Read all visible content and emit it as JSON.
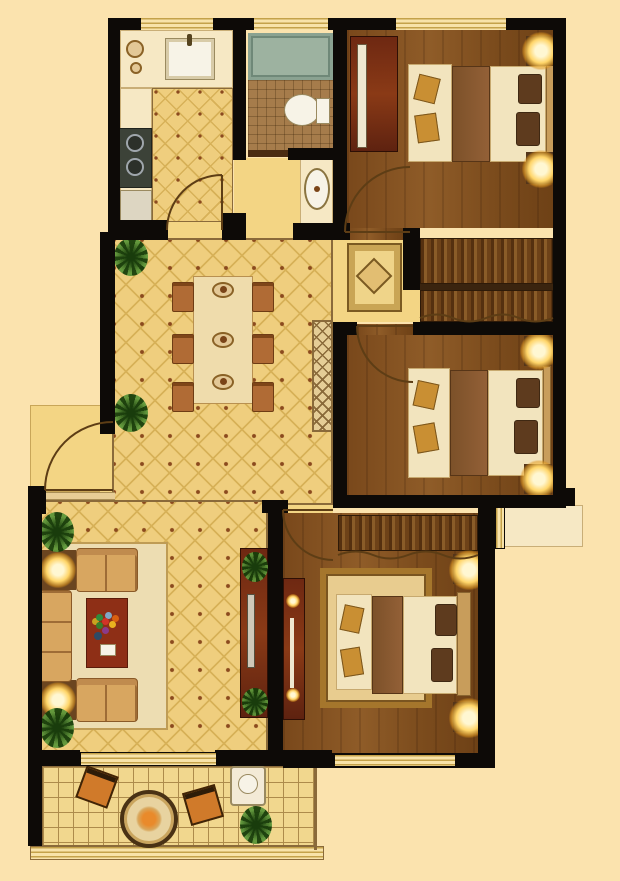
{
  "meta": {
    "kind": "architectural-floor-plan",
    "render_style": "top-down color interior rendering",
    "text_labels": [],
    "canvas": {
      "width": 620,
      "height": 881
    }
  },
  "palette": {
    "background": "#FBE3AE",
    "wall": "#0D0A07",
    "tile_floor": "#EFCE7E",
    "tile_dot": "#8B4A1E",
    "hall_floor": "#F3D584",
    "wood_floor": "#82501F",
    "bath_floor": "#A67C4B",
    "bathtub": "#9DB2A0",
    "fixture_white": "#F7F3E7",
    "furniture_dark_red": "#7E2E12",
    "coffee_table_red": "#8E2F16",
    "lamp_glow": "#FFD569",
    "balcony_floor": "#F1D78E",
    "rug_cream": "#EDDDB2",
    "headboard_gold": "#C89D5B",
    "plant_green": "#5C963A"
  },
  "rooms": [
    {
      "id": "kitchen",
      "position": "top-left",
      "floor": "diamond-tile",
      "furniture": [
        "l-shaped-counter",
        "double-sink-with-faucet",
        "two-burner-stove",
        "base-cabinet",
        "two-bowls"
      ],
      "openings": [
        "window-north",
        "hinged-door-arc-south"
      ]
    },
    {
      "id": "bathroom",
      "position": "top-center",
      "floor": "square-tile",
      "furniture": [
        "bathtub",
        "toilet"
      ],
      "openings": [
        "window-north",
        "sliding-door-south"
      ]
    },
    {
      "id": "basin-niche",
      "position": "center-top",
      "floor": "plain",
      "furniture": [
        "vanity-counter",
        "oval-wash-basin"
      ],
      "openings": [
        "open-to-hallway"
      ]
    },
    {
      "id": "bedroom-1",
      "position": "top-right",
      "floor": "wood-plank",
      "furniture": [
        "double-bed-with-bench",
        "two-pillows",
        "two-nightstands-with-glowing-lamps",
        "dark-red-sliding-wardrobe"
      ],
      "openings": [
        "window-north",
        "hinged-door-arc-south"
      ]
    },
    {
      "id": "closet-strips",
      "position": "right-center",
      "floor": "wood-slats",
      "furniture": [
        "hanging-closet-for-bedroom-1",
        "hanging-closet-for-bedroom-2",
        "curtain-edge"
      ],
      "openings": []
    },
    {
      "id": "bedroom-2",
      "position": "right-middle",
      "floor": "wood-plank",
      "furniture": [
        "double-bed-with-bench",
        "two-pillows",
        "two-nightstands-with-glowing-lamps"
      ],
      "openings": [
        "hinged-door-arc-north"
      ]
    },
    {
      "id": "hallway",
      "position": "center",
      "floor": "plain",
      "furniture": [
        "square-medallion-rug",
        "lattice-display-cabinet"
      ],
      "openings": [
        "connects-dining-bedrooms-bathroom"
      ]
    },
    {
      "id": "dining-room",
      "position": "center-left",
      "floor": "diamond-tile",
      "furniture": [
        "rectangular-dining-table",
        "six-chairs",
        "three-place-settings",
        "two-corner-plants"
      ],
      "openings": [
        "open-to-living-room"
      ]
    },
    {
      "id": "entry",
      "position": "left-middle",
      "floor": "plain",
      "furniture": [
        "threshold-step"
      ],
      "openings": [
        "entrance-door-arc-outward"
      ]
    },
    {
      "id": "living-room",
      "position": "bottom-left",
      "floor": "diamond-tile",
      "furniture": [
        "three-seat-sofa",
        "two-loveseats",
        "two-end-tables-with-glowing-lamps",
        "red-coffee-table-with-flower-bouquet",
        "area-rug",
        "tv-cabinet-dark-red",
        "tv",
        "two-plants"
      ],
      "openings": [
        "sliding-door-to-balcony-south"
      ]
    },
    {
      "id": "master-bedroom",
      "position": "bottom-right",
      "floor": "wood-plank",
      "furniture": [
        "double-bed-with-bench",
        "ornate-border-rug",
        "two-pillows",
        "two-nightstands-with-glowing-lamps",
        "dresser-dark-red-with-knobs",
        "curtained-wardrobe-strip"
      ],
      "openings": [
        "hinged-door-arc-north",
        "window-east-with-sill",
        "window-south"
      ]
    },
    {
      "id": "balcony",
      "position": "bottom",
      "floor": "grid-tile",
      "furniture": [
        "round-table-with-flower",
        "two-orange-chairs",
        "white-utility-unit",
        "plant"
      ],
      "openings": [
        "glass-railing-south",
        "sliding-door-north"
      ]
    }
  ],
  "counts": {
    "bedrooms": 3,
    "bathrooms": 1,
    "balconies": 1,
    "hinged_door_arcs": 5,
    "sliding_doors": 2,
    "windows": 5,
    "glowing_lamps": 8,
    "plants": 6,
    "dining_chairs": 6
  }
}
